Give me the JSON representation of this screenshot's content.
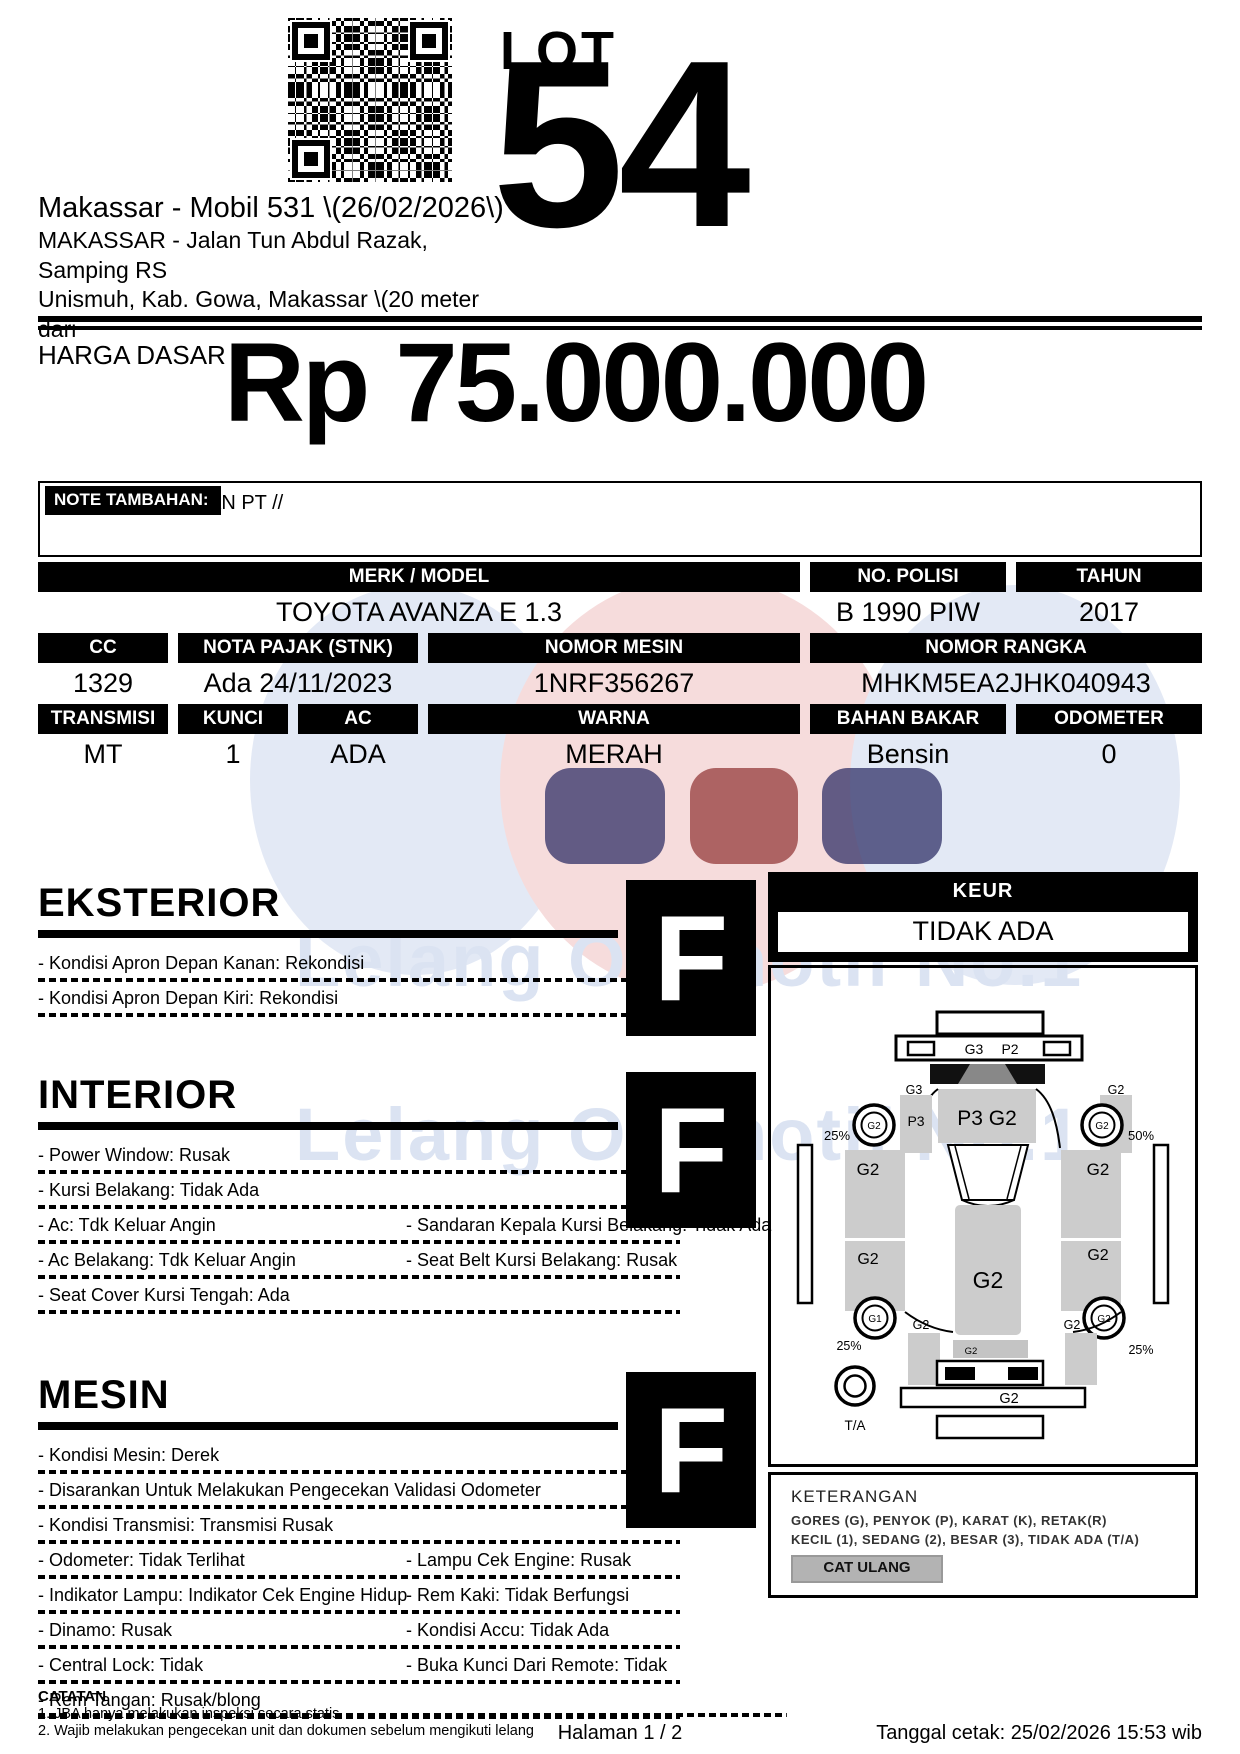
{
  "header": {
    "lot_label": "LOT",
    "lot_number": "54",
    "auction_title": "Makassar - Mobil 531 \\(26/02/2026\\)",
    "address_line1": "MAKASSAR - Jalan Tun Abdul Razak, Samping RS",
    "address_line2": "Unismuh, Kab. Gowa, Makassar \\(20 meter dari"
  },
  "price": {
    "label": "HARGA DASAR :",
    "value": "Rp 75.000.000"
  },
  "note": {
    "label": "NOTE TAMBAHAN:",
    "value": "AN PT //"
  },
  "spec": {
    "rows": [
      [
        {
          "label": "MERK / MODEL",
          "value": "TOYOTA AVANZA E 1.3"
        },
        {
          "label": "NO. POLISI",
          "value": "B 1990 PIW"
        },
        {
          "label": "TAHUN",
          "value": "2017"
        }
      ],
      [
        {
          "label": "CC",
          "value": "1329"
        },
        {
          "label": "NOTA PAJAK (STNK)",
          "value": "Ada 24/11/2023"
        },
        {
          "label": "NOMOR MESIN",
          "value": "1NRF356267"
        },
        {
          "label": "NOMOR RANGKA",
          "value": "MHKM5EA2JHK040943"
        }
      ],
      [
        {
          "label": "TRANSMISI",
          "value": "MT"
        },
        {
          "label": "KUNCI",
          "value": "1"
        },
        {
          "label": "AC",
          "value": "ADA"
        },
        {
          "label": "WARNA",
          "value": "MERAH"
        },
        {
          "label": "BAHAN BAKAR",
          "value": "Bensin"
        },
        {
          "label": "ODOMETER",
          "value": "0"
        }
      ]
    ]
  },
  "sections": [
    {
      "title": "EKSTERIOR",
      "grade": "F",
      "items": [
        "- Kondisi Apron Depan Kanan: Rekondisi",
        "- Kondisi Apron Depan Kiri: Rekondisi"
      ],
      "pairs": []
    },
    {
      "title": "INTERIOR",
      "grade": "F",
      "items": [
        "- Power Window: Rusak",
        "- Kursi Belakang: Tidak Ada"
      ],
      "pairs": [
        [
          "- Ac: Tdk Keluar Angin",
          "- Sandaran Kepala Kursi Belakang: Tidak Ada"
        ],
        [
          "- Ac Belakang: Tdk Keluar Angin",
          "- Seat Belt Kursi Belakang: Rusak"
        ],
        [
          "- Seat Cover Kursi Tengah: Ada",
          ""
        ]
      ]
    },
    {
      "title": "MESIN",
      "grade": "F",
      "items": [
        "- Kondisi Mesin: Derek",
        "- Disarankan Untuk Melakukan Pengecekan Validasi Odometer",
        "- Kondisi Transmisi: Transmisi Rusak"
      ],
      "pairs": [
        [
          "- Odometer: Tidak Terlihat",
          "- Lampu Cek Engine: Rusak"
        ],
        [
          "- Indikator Lampu: Indikator Cek Engine Hidup",
          "- Rem Kaki: Tidak Berfungsi"
        ],
        [
          "- Dinamo: Rusak",
          "- Kondisi Accu: Tidak Ada"
        ],
        [
          "- Central Lock: Tidak",
          "- Buka Kunci Dari Remote: Tidak"
        ],
        [
          "- Rem Tangan: Rusak/blong",
          ""
        ]
      ]
    }
  ],
  "keur": {
    "label": "KEUR",
    "value": "TIDAK ADA"
  },
  "diagram": {
    "front_bar_left": "G3",
    "front_bar_right": "P2",
    "hood": "P3 G2",
    "left_fender_top": "G3",
    "left_fender": "P3",
    "right_fender_top": "G2",
    "front_left_wheel": "G2",
    "front_right_wheel": "G2",
    "front_left_pct": "25%",
    "front_right_pct": "50%",
    "left_front_door": "G2",
    "right_front_door": "G2",
    "roof": "G2",
    "left_rear_panel": "G2",
    "right_rear_panel": "G2",
    "rear_left_wheel": "G1",
    "rear_right_wheel": "G2",
    "rear_left_side": "G2",
    "rear_right_side": "G2",
    "rear_left_pct": "25%",
    "rear_right_pct": "25%",
    "rear_window": "G2",
    "rear_bumper": "G2",
    "spare_tire": "T/A"
  },
  "keterangan": {
    "title": "KETERANGAN",
    "line1": "GORES (G), PENYOK (P), KARAT (K), RETAK(R)",
    "line2": "KECIL (1), SEDANG (2), BESAR (3), TIDAK ADA (T/A)",
    "button": "CAT ULANG"
  },
  "footer": {
    "catatan": "CATATAN",
    "note1": "1. JBA hanya melakukan inspeksi secara statis",
    "note2": "2. Wajib melakukan pengecekan unit dan dokumen sebelum mengikuti lelang",
    "page": "Halaman 1 / 2",
    "printed": "Tanggal cetak: 25/02/2026 15:53 wib"
  },
  "colors": {
    "watermark_blue": "#dde5f3",
    "watermark_pink": "#f4d9d9",
    "watermark_navy": "#24245e",
    "watermark_red": "#8e2f2f",
    "panel_gray": "#cccccc",
    "button_gray": "#b3b3b3"
  }
}
